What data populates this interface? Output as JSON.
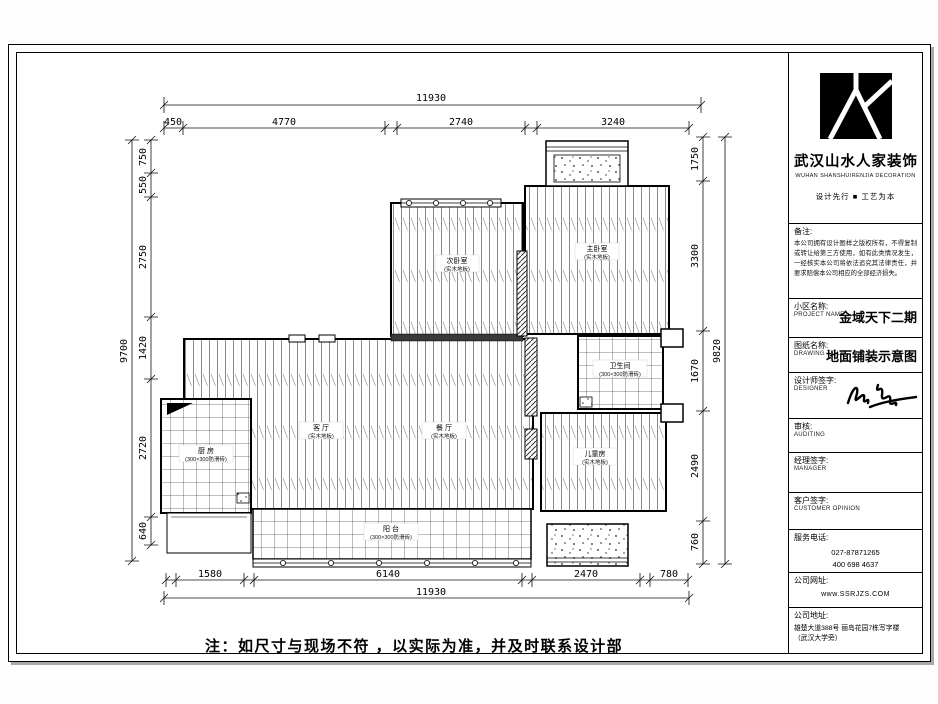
{
  "sheet": {
    "note": "注：如尺寸与现场不符 ，以实际为准，并及时联系设计部"
  },
  "title_block": {
    "company_name": "武汉山水人家装饰",
    "company_name_en": "WUHAN SHANSHUIRENJIA DECORATION",
    "tagline": "设计先行 ■ 工艺为本",
    "remark_label": "备注:",
    "remark_text": "本公司拥有设计图样之版权所有，不得复制或转让给第三方使用，如有此类情况发生，一经核实本公司将依法追究其法律责任，并要求赔偿本公司相应的全部经济损失。",
    "project_label": "小区名称:",
    "project_label_en": "PROJECT NAME",
    "project_name": "金域天下二期",
    "drawing_label": "图纸名称:",
    "drawing_label_en": "DRAWING TITLE",
    "drawing_title": "地面铺装示意图",
    "designer_label": "设计师签字:",
    "designer_label_en": "DESIGNER",
    "audit_label": "审核:",
    "audit_label_en": "AUDITING",
    "manager_label": "经理签字:",
    "manager_label_en": "MANAGER",
    "customer_label": "客户签字:",
    "customer_label_en": "CUSTOMER OPINION",
    "phone_label": "服务电话:",
    "phone1": "027-87871265",
    "phone2": "400 698 4637",
    "website_label": "公司网址:",
    "website": "www.SSRJZS.COM",
    "address_label": "公司地址:",
    "address_line1": "雄楚大道388号 丽岛花园7栋写字楼",
    "address_line2": "（武汉大学旁）"
  },
  "plan": {
    "rooms": [
      {
        "name": "次卧室",
        "material": "(实木地板)"
      },
      {
        "name": "主卧室",
        "material": "(实木地板)"
      },
      {
        "name": "客 厅",
        "material": "(实木地板)"
      },
      {
        "name": "餐 厅",
        "material": "(实木地板)"
      },
      {
        "name": "儿童房",
        "material": "(实木地板)"
      },
      {
        "name": "卫生间",
        "material": "(300×300防滑砖)"
      },
      {
        "name": "厨 房",
        "material": "(300×300防滑砖)"
      },
      {
        "name": "阳 台",
        "material": "(300×300防滑砖)"
      }
    ],
    "dims": {
      "top_total": "11930",
      "top": [
        "450",
        "4770",
        "2740",
        "3240"
      ],
      "left_total": "9700",
      "left": [
        "750",
        "550",
        "2750",
        "1420",
        "2720",
        "640"
      ],
      "right_total": "9820",
      "right": [
        "1750",
        "3300",
        "1670",
        "2490",
        "760"
      ],
      "bottom_total": "11930",
      "bottom": [
        "1580",
        "6140",
        "2470",
        "780"
      ]
    }
  }
}
